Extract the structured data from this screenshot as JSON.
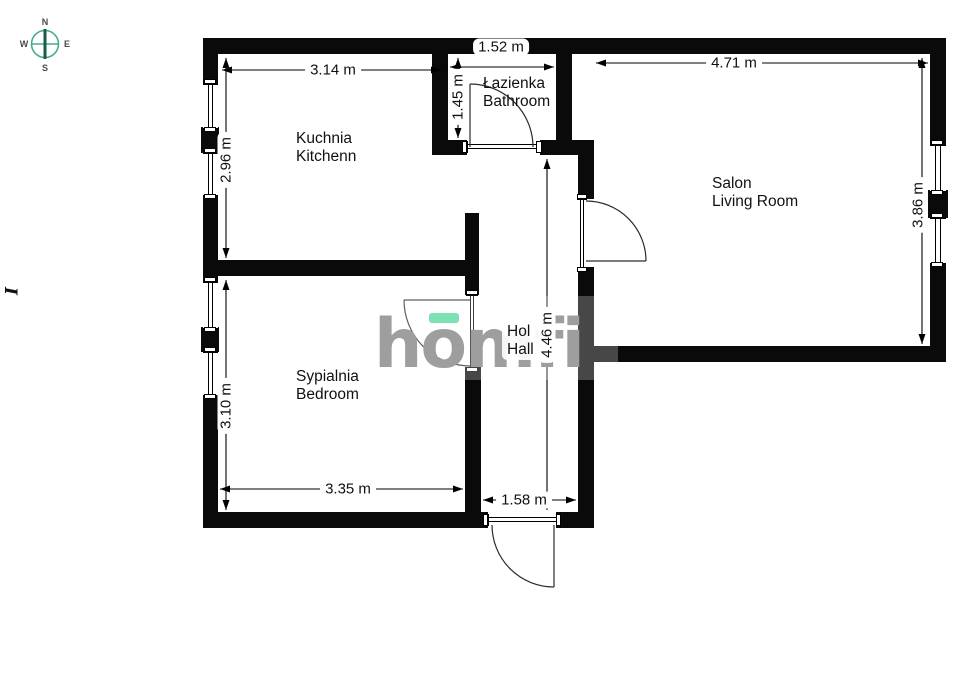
{
  "compass": {
    "n": "N",
    "e": "E",
    "s": "S",
    "w": "W"
  },
  "watermark": {
    "text": "homfi"
  },
  "rooms": {
    "kitchen": {
      "pl": "Kuchnia",
      "en": "Kitchenn"
    },
    "bathroom": {
      "pl": "Łazienka",
      "en": "Bathroom"
    },
    "living": {
      "pl": "Salon",
      "en": "Living Room"
    },
    "bedroom": {
      "pl": "Sypialnia",
      "en": "Bedroom"
    },
    "hall": {
      "pl": "Hol",
      "en": "Hall"
    }
  },
  "dims": {
    "kitchen_w": "3.14 m",
    "kitchen_h": "2.96 m",
    "bathroom_w": "1.52 m",
    "bathroom_h": "1.45 m",
    "living_w": "4.71 m",
    "living_h": "3.86 m",
    "bedroom_w": "3.35 m",
    "bedroom_h": "3.10 m",
    "hall_h": "4.46 m",
    "entrance_w": "1.58 m"
  },
  "artifact": {
    "glyph": "I"
  },
  "colors": {
    "wall": "#0a0a0a",
    "compass_green": "#43ad8d",
    "compass_needle": "#155c49",
    "watermark_gray": "#9e9e9e",
    "watermark_accent": "#7de1b3"
  }
}
